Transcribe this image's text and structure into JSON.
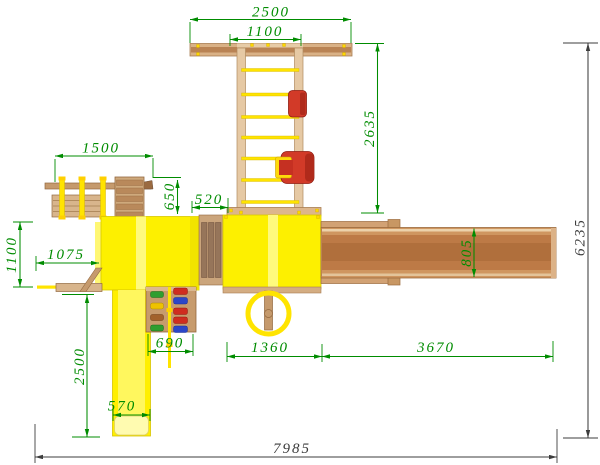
{
  "colors": {
    "dimension_green": "#008c00",
    "dimension_dark": "#3d3d3d",
    "roof_yellow": "#fdf000",
    "slide_yellow": "#ffef00",
    "rope_yellow": "#ffe400",
    "wood_light": "#ddb68c",
    "wood_mid": "#c59a6d",
    "wood_dark": "#b5713f",
    "seat_red": "#d23a28",
    "background": "#ffffff"
  },
  "dims": {
    "swing_beam_length": "2500",
    "swing_bay_width": "1100",
    "swing_frame_depth": "2635",
    "monkey_bars_length": "1500",
    "gym_offset": "650",
    "bridge_span": "520",
    "balance_beam_reach": "1075",
    "platform_depth": "1100",
    "slide_run": "2500",
    "climbing_wall_width": "690",
    "slide_width": "570",
    "tower_span": "1360",
    "ramp_length": "3670",
    "ramp_width": "805",
    "overall_depth": "6235",
    "overall_length": "7985"
  }
}
